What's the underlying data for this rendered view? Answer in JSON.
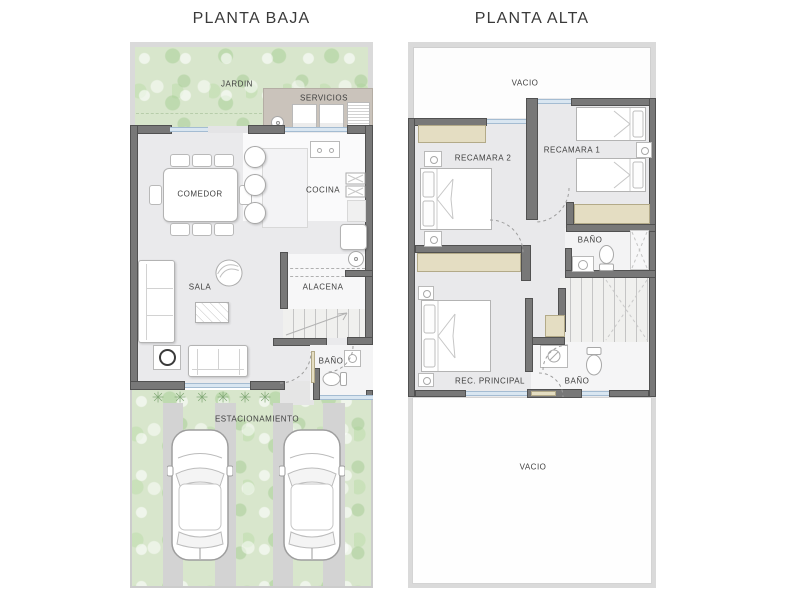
{
  "planta_baja": {
    "title": "PLANTA BAJA",
    "labels": {
      "jardin": "JARDIN",
      "servicios": "SERVICIOS",
      "comedor": "COMEDOR",
      "cocina": "COCINA",
      "sala": "SALA",
      "alacena": "ALACENA",
      "bano": "BAÑO",
      "estacionamiento": "ESTACIONAMIENTO"
    }
  },
  "planta_alta": {
    "title": "PLANTA ALTA",
    "labels": {
      "vacio_top": "VACIO",
      "recamara2": "RECAMARA 2",
      "recamara1": "RECAMARA 1",
      "bano_top": "BAÑO",
      "rec_principal": "REC. PRINCIPAL",
      "bano_bottom": "BAÑO",
      "vacio_bottom": "VACIO"
    }
  },
  "colors": {
    "wall_dark": "#787878",
    "wall_light": "#dadada",
    "floor": "#e9e9eb",
    "garden_green": "#d8e6cc",
    "closet_tan": "#e4ddc2",
    "window_blue": "#d9e6f1",
    "parking_strip": "#d3d3d3",
    "label_text": "#3e3e3e"
  }
}
